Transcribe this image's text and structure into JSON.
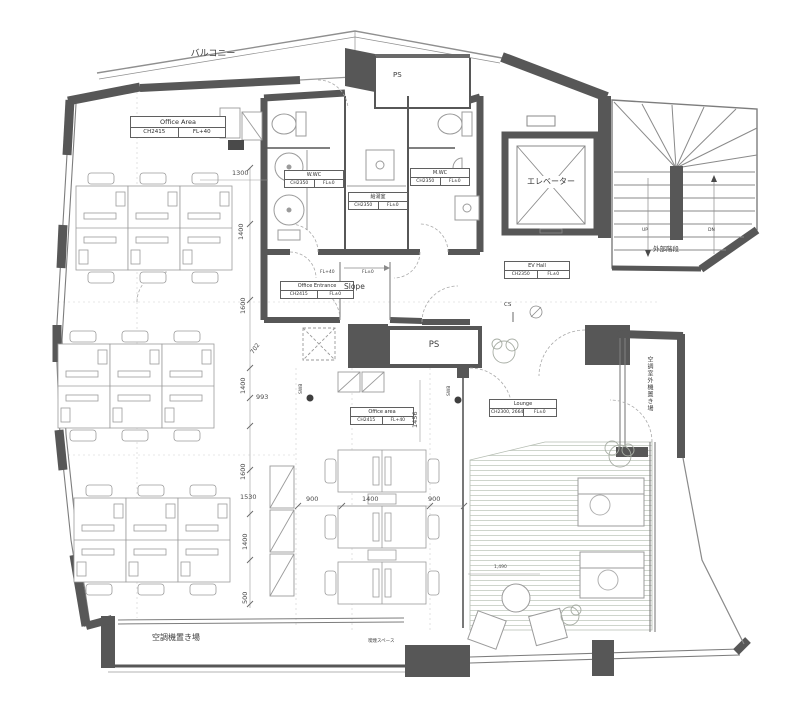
{
  "texts": {
    "balcony": "バルコニー",
    "ps_top": "PS",
    "ps_mid": "PS",
    "elevator": "エレベーター",
    "stairs": "外部階段",
    "up": "UP",
    "dn": "DN",
    "slope": "Slope",
    "cs": "CS",
    "swb_left": "SWB",
    "swb_right": "SWB",
    "fl40": "FL+40",
    "fl0": "FL±0",
    "ac_outdoor": "空調室外機置き場",
    "ac_bottom": "空調機置き場",
    "smoking": "喫煙スペース"
  },
  "rooms": {
    "office_top": {
      "name": "Office Area",
      "ch": "CH2415",
      "fl": "FL+40"
    },
    "w_wc": {
      "name": "W.WC",
      "ch": "CH2350",
      "fl": "FL±0"
    },
    "kitchen": {
      "name": "給湯室",
      "ch": "CH2350",
      "fl": "FL±0"
    },
    "m_wc": {
      "name": "M.WC",
      "ch": "CH2350",
      "fl": "FL±0"
    },
    "entrance": {
      "name": "Office Entrance",
      "ch": "CH2415",
      "fl": "FL±0"
    },
    "ev_hall": {
      "name": "EV Hall",
      "ch": "CH2350",
      "fl": "FL±0"
    },
    "office_center": {
      "name": "Office area",
      "ch": "CH2415",
      "fl": "FL+40"
    },
    "lounge": {
      "name": "Lounge",
      "ch": "CH2300, 2664",
      "fl": "FL±0"
    }
  },
  "dimensions": {
    "d1300": "1300",
    "d1400a": "1400",
    "d1600a": "1600",
    "d702": "702",
    "d1400b": "1400",
    "d993": "993",
    "d1600b": "1600",
    "d1530": "1530",
    "d1400c": "1400",
    "d500": "500",
    "d900a": "900",
    "d1400d": "1400",
    "d900b": "900",
    "d1456": "1456",
    "d1490": "1,490"
  },
  "colors": {
    "wall": "#575757",
    "thin_line": "#8f8f8f",
    "plank": "#c9d1c6"
  }
}
